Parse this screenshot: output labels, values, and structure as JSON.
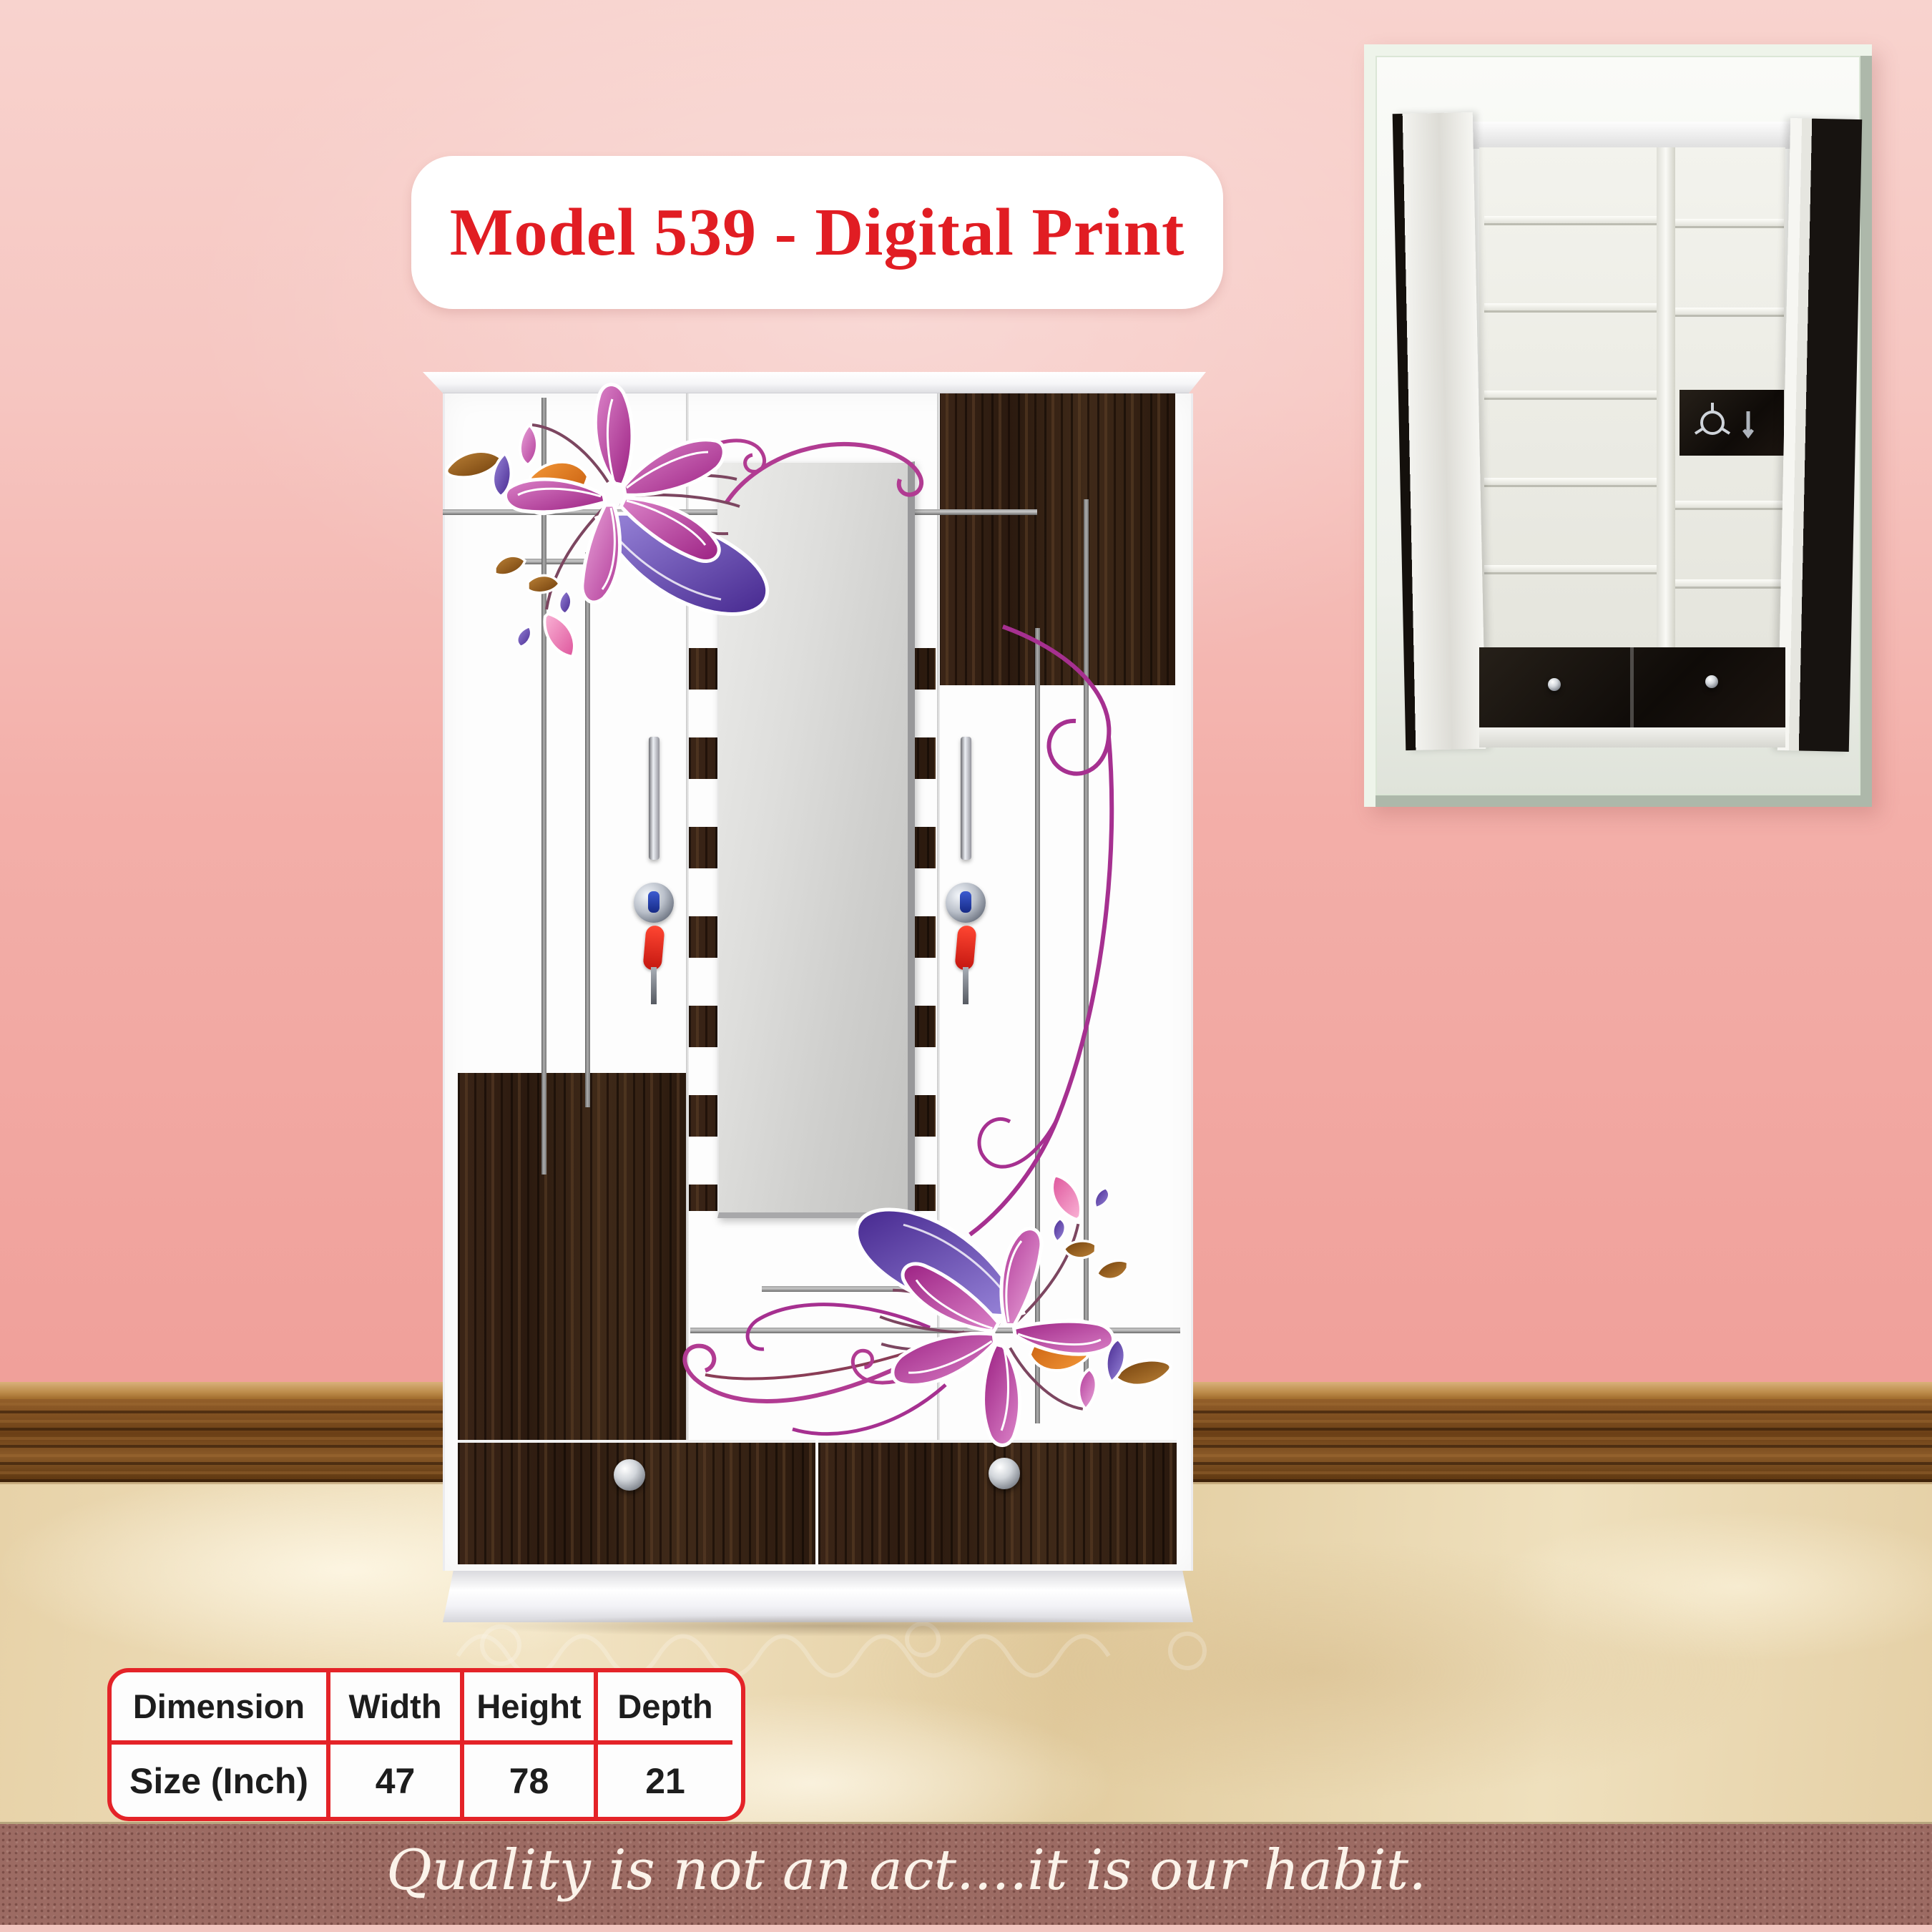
{
  "poster": {
    "title": "Model 539 - Digital Print",
    "quote": "Quality is not an act....it is our habit.",
    "spec_table": {
      "col_headers": [
        "Dimension",
        "Width",
        "Height",
        "Depth"
      ],
      "row_header": "Size (Inch)",
      "values": [
        "47",
        "78",
        "21"
      ]
    },
    "colors": {
      "title_red": "#e11d23",
      "table_border_red": "#e42328",
      "wall_pink_top": "#f8d3ce",
      "wall_pink_bottom": "#f09d98",
      "wardrobe_wood_dark": "#33221a",
      "skirting_brown": "#7c4c1e",
      "floor_marble": "#ead8b3",
      "footer_maroon": "#9c6b63",
      "flower_magenta": "#b93a9b",
      "flower_purple": "#5e42ab",
      "accent_orange": "#e0761f",
      "inset_frame_green": "#dbe6d6"
    }
  }
}
